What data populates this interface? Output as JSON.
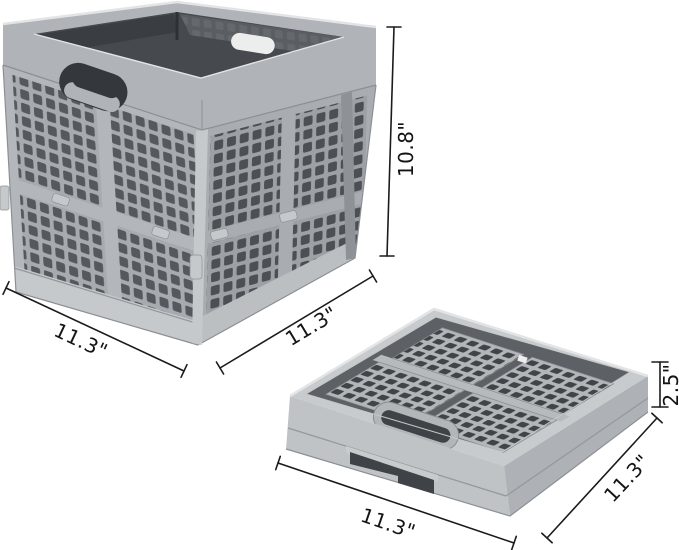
{
  "scene": {
    "subject": "collapsible folding storage crate product dimension illustration",
    "views": [
      "assembled crate (upper left)",
      "folded flat crate (lower right)"
    ]
  },
  "dimensions": {
    "assembled": {
      "height": "10.8\"",
      "width": "11.3\"",
      "depth": "11.3\""
    },
    "folded": {
      "height": "2.5\"",
      "width": "11.3\"",
      "depth": "11.3\""
    }
  },
  "colors": {
    "background": "#ffffff",
    "dim_line": "#1b1b1b",
    "dim_text": "#141414",
    "rim_light": "#e2e4e5",
    "rim_mid": "#b0b3b7",
    "rim_dark": "#8c9094",
    "interior": "#46494d",
    "inner_wall": "#5a5e62",
    "inner_wall_dark": "#3a3d41",
    "face_left": "#b3b6ba",
    "face_right": "#a9adb1",
    "mesh_left": "#a7abaf",
    "mesh_right": "#9da1a5",
    "hole_left": "#55585c",
    "hole_right": "#4c5054",
    "base_light": "#c6c9cc",
    "base_mid": "#bcbfc2",
    "edge_rail": "#8e9296",
    "seam": "#94979b",
    "stadium_hole": "#34383c",
    "tray_rim": "#c8cbcd",
    "tray_deck": "#5d6165",
    "tray_panel": "#b3b6b9",
    "tray_hole": "#404448",
    "tray_divider": "#b7babd",
    "tray_wall_left": "#c0c3c6",
    "tray_wall_right": "#aeb1b5",
    "tray_edge": "#888c90",
    "tray_inner_hi": "#c4c7c9",
    "notch_dark": "#3f4347",
    "highlight": "#eceded"
  }
}
